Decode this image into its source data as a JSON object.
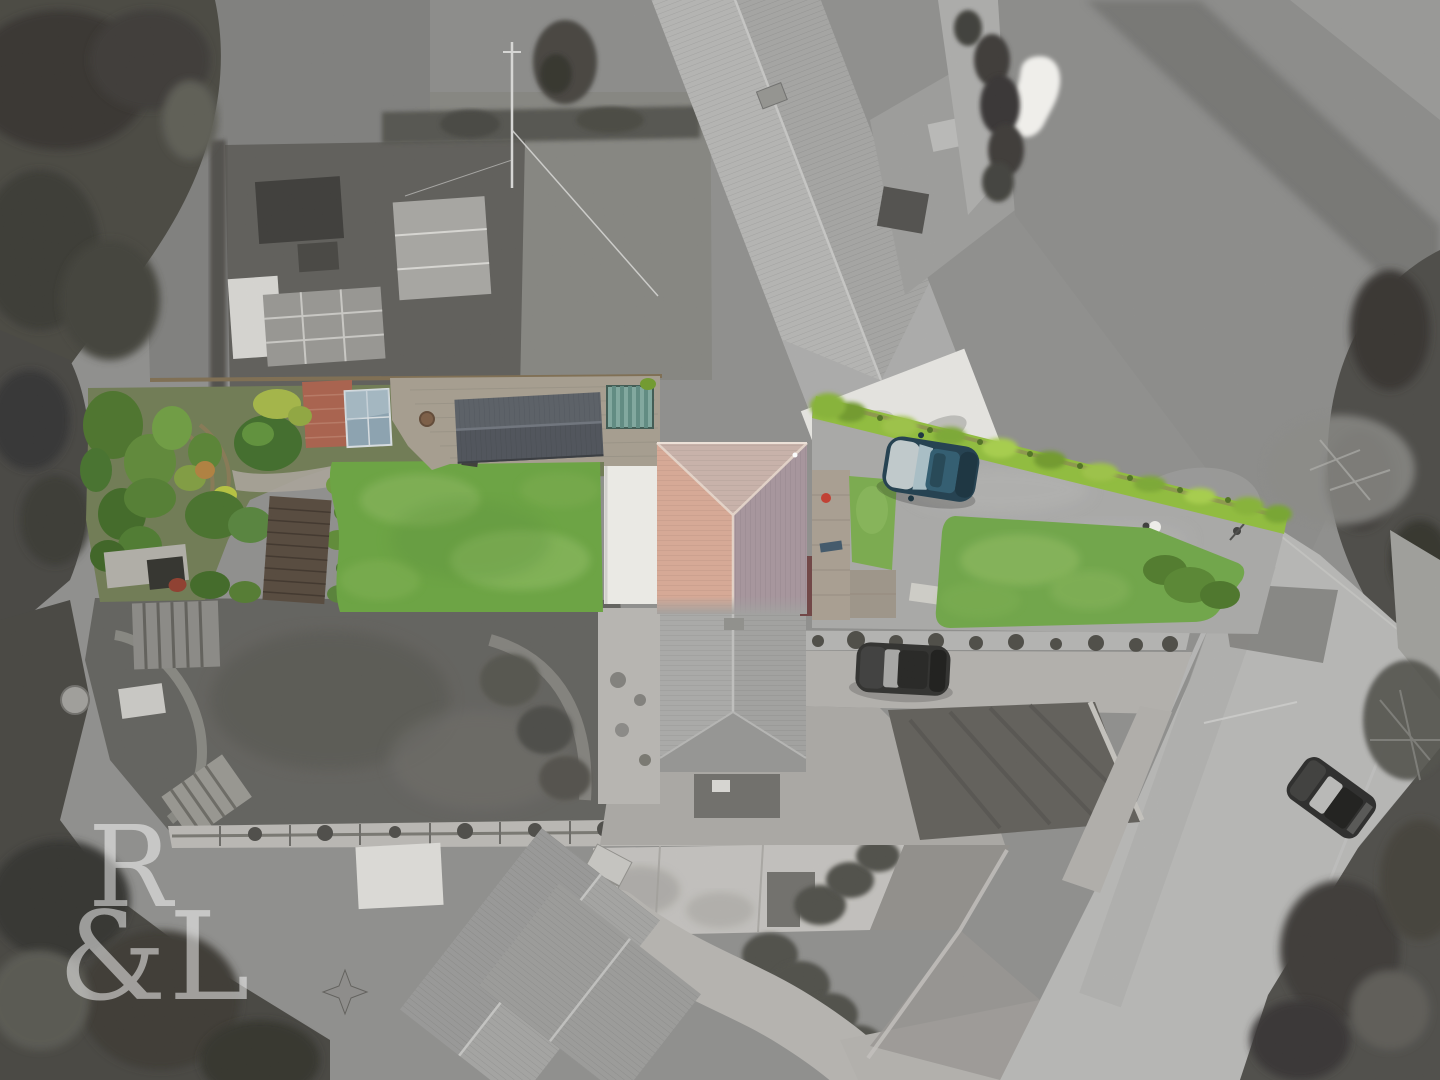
{
  "image": {
    "kind": "aerial-drone-photograph",
    "style": "selective-colour: subject property shown in colour, all surroundings desaturated to greyscale",
    "width_px": 1440,
    "height_px": 1080
  },
  "watermark": {
    "text": "R&L",
    "line1": "R",
    "line2": "&L",
    "color_note": "semi-transparent white serif monogram, bottom left"
  },
  "palette": {
    "base_gray": "#8e8e8c",
    "field_gray": "#84847f",
    "tree_dark": "#44433e",
    "road_gray": "#b6b6b4",
    "bunker_white": "#f2f1ed",
    "white_roof": "#edece7",
    "roof_pink": "#d8a894",
    "roof_mauve": "#a6949c",
    "roof_top_pink": "#c9b2aa",
    "garage_slate": "#4c5158",
    "brick_patio": "#a85f4a",
    "deck_brown": "#54473a",
    "greenhouse_glass": "#8ba2b0",
    "teal_panels": "#7fa79e",
    "lawn_green": "#69a33f",
    "front_lawn_green": "#6ea546",
    "hedge_green": "#8fbc3a",
    "bush_green": "#3f6b28",
    "car_blue": "#1f3d4c",
    "car_grey": "#2e2e2c",
    "car_road": "#2a2a28",
    "watermark_white": "#ffffff"
  },
  "scene": {
    "highlighted_in_colour": [
      {
        "name": "rear-garden",
        "desc": "mature shrub borders, brick patio, greenhouse, curved timber pergola and dark timber deck"
      },
      {
        "name": "rear-lawn",
        "desc": "long bright green lawn behind the house"
      },
      {
        "name": "garage-outbuilding",
        "desc": "dark slate pitched roof beside rear patio"
      },
      {
        "name": "teal-panel-store",
        "desc": "ribbed teal panels next to garage"
      },
      {
        "name": "white-flat-roof-extension",
        "desc": "white flat roof on left side of main house"
      },
      {
        "name": "main-house",
        "desc": "hipped roof, salmon-pink tiles (left face) and mauve-grey tiles (right face)"
      },
      {
        "name": "driveway",
        "desc": "tarmac drive to the right of the house"
      },
      {
        "name": "boundary-hedge",
        "desc": "long bright yellow-green hedge running along the drive"
      },
      {
        "name": "front-lawn",
        "desc": "green lawn beside the drive, shrub bank on its right"
      }
    ],
    "desaturated_surroundings": [
      {
        "name": "golf-course",
        "desc": "fairway with white sand bunker and putting green, top right"
      },
      {
        "name": "long-outbuilding",
        "desc": "large pitched-roof barn/stable block, top centre, white flat section at near end"
      },
      {
        "name": "allotment-garden",
        "desc": "greenhouses, cold frames and white panels, upper left"
      },
      {
        "name": "woodland",
        "desc": "dense dark trees along left edge, corners and right of lane"
      },
      {
        "name": "lane",
        "desc": "country lane running down the right-hand side"
      },
      {
        "name": "neighbouring-house",
        "desc": "hipped grey roof immediately below the subject house"
      },
      {
        "name": "second-neighbouring-house",
        "desc": "large angled grey roof with small white shed, bottom centre"
      },
      {
        "name": "rear-neighbour-garden",
        "desc": "lawn with pergola, shed and arbour, lower left"
      },
      {
        "name": "concrete-yard",
        "desc": "light paved yard with dark tarmac patch, bottom centre"
      }
    ],
    "vehicles": [
      {
        "name": "blue-car",
        "color": "#1f3d4c",
        "location": "parked on driveway beside hedge",
        "in_colour": true
      },
      {
        "name": "grey-car",
        "color": "#2e2e2c",
        "location": "parked on gravel forecourt",
        "in_colour": false
      },
      {
        "name": "road-car",
        "color": "#2a2a28",
        "location": "parked on lane, bottom right",
        "in_colour": false
      }
    ],
    "people": [
      {
        "name": "pedestrian-with-white-umbrella",
        "location": "on drive near lane junction"
      },
      {
        "name": "pedestrian",
        "location": "at drive / lane junction"
      }
    ]
  }
}
